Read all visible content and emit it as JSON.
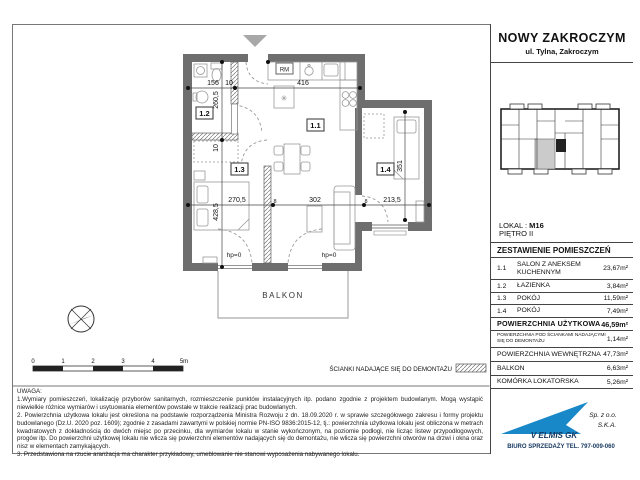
{
  "header": {
    "title": "NOWY ZAKROCZYM",
    "subtitle": "ul. Tylna, Zakroczym"
  },
  "unit": {
    "lokal_label": "LOKAL :",
    "lokal_value": "M16",
    "floor": "PIĘTRO II"
  },
  "rooms_table": {
    "title": "ZESTAWIENIE POMIESZCZEŃ",
    "rows": [
      {
        "no": "1.1",
        "name": "SALON Z ANEKSEM KUCHENNYM",
        "area": "23,67m²"
      },
      {
        "no": "1.2",
        "name": "ŁAZIENKA",
        "area": "3,84m²"
      },
      {
        "no": "1.3",
        "name": "POKÓJ",
        "area": "11,59m²"
      },
      {
        "no": "1.4",
        "name": "POKÓJ",
        "area": "7,49m²"
      }
    ],
    "usable_label": "POWIERZCHNIA UŻYTKOWA",
    "usable_value": "46,59m²",
    "under_walls_label": "POWIERZCHNIA POD ŚCIANKAMI NADAJĄCYMI SIĘ DO DEMONTAŻU",
    "under_walls_value": "1,14m²",
    "internal_label": "POWIERZCHNIA WEWNĘTRZNA",
    "internal_value": "47,73m²",
    "balcony_label": "BALKON",
    "balcony_value": "6,63m²",
    "storage_label": "KOMÓRKA LOKATORSKA",
    "storage_value": "5,26m²"
  },
  "plan": {
    "room_labels": {
      "r11": "1.1",
      "r12": "1.2",
      "r13": "1.3",
      "r14": "1.4"
    },
    "annotations": {
      "rm": "RM",
      "balcony": "BALKON",
      "hp_left": "hp=0",
      "hp_right": "hp=0"
    },
    "dimensions": {
      "w_bath": "156",
      "wall10_top": "10",
      "w_kitchen": "416",
      "h_bath": "260,5",
      "wall10_left": "10",
      "h_room13": "428,5",
      "w_room13": "270,5",
      "wall8_a": "8",
      "w_living": "302",
      "wall8_b": "8",
      "w_room14": "213,5",
      "h_room14": "351"
    }
  },
  "legend": {
    "demountable_walls": "ŚCIANKI NADAJĄCE SIĘ DO DEMONTAŻU"
  },
  "scale_bar": {
    "ticks": [
      "0",
      "1",
      "2",
      "3",
      "4",
      "5m"
    ]
  },
  "notes": {
    "title": "UWAGA:",
    "items": [
      "1.Wymiary pomieszczeń, lokalizację przyborów sanitarnych, rozmieszczenie punktów instalacyjnych itp. podano zgodnie z projektem budowlanym. Mogą wystąpić niewielkie różnice wymiarów i usytuowania elementów powstałe w trakcie realizacji prac budowlanych.",
      "2. Powierzchnia użytkowa lokalu jest określona na podstawie rozporządzenia Ministra Rozwoju z dn. 18.09.2020 r. w sprawie szczegółowego zakresu i formy projektu budowlanego (Dz.U. 2020 poz. 1609); zgodnie z zasadami zawartymi w polskiej normie PN-ISO 9836:2015-12, tj.: powierzchnia użytkowa lokalu jest obliczona w metrach kwadratowych z dokładnością do dwóch miejsc po przecinku, dla wymiarów lokalu w stanie wykończonym, na poziomie podłogi, nie licząc listew przypodłogowych, progów itp. Do powierzchni użytkowej lokalu nie wlicza się powierzchni elementów nadających się do demontażu, nie wlicza się powierzchni otworów na drzwi i okna oraz nisz w elementach zamykających.",
      "3. Przedstawiona na rzucie aranżacja ma charakter przykładowy, umeblowanie nie stanowi wyposażenia nabywanego lokalu."
    ]
  },
  "logo": {
    "company": "V ELMIS GK",
    "legal_form_line1": "Sp. z o.o.",
    "legal_form_line2": "S.K.A.",
    "sales_office": "BIURO SPRZEDAŻY TEL. 797-009-060"
  },
  "colors": {
    "wall": "#6e6e6e",
    "logo_blue": "#1888c8",
    "unit_highlight": "#cbcbcb",
    "entrance_arrow": "#a8a8a8"
  }
}
